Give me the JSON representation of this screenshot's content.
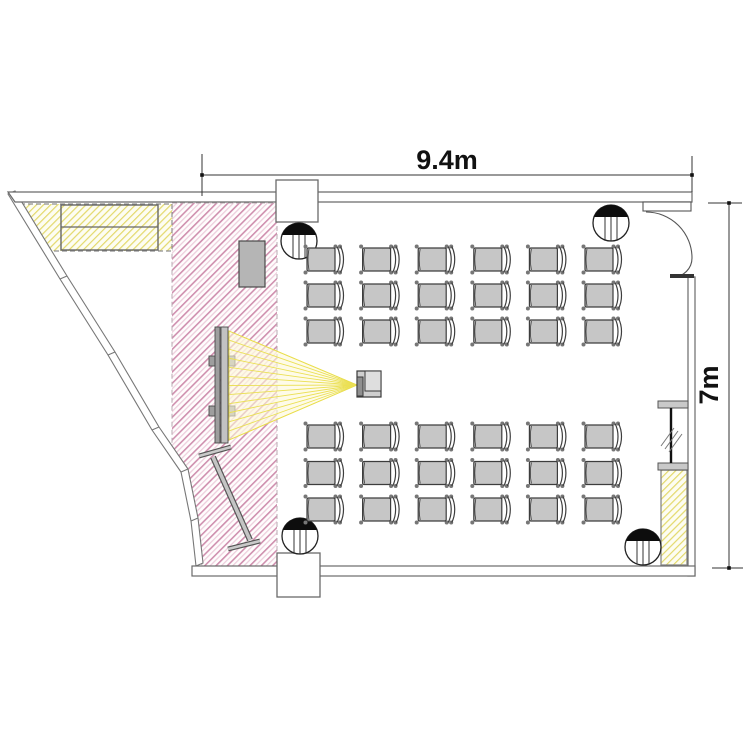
{
  "drawing": {
    "type": "floor-plan",
    "room": "classroom",
    "width_label": "9.4m",
    "height_label": "7m"
  },
  "seating": {
    "columns": 6,
    "front_rows": 3,
    "back_rows": 3,
    "total_chairs": 36
  },
  "symbols": {
    "speaker_icon_count": 4,
    "door_icon": "swing-door",
    "projector_icon": "ceiling-projector",
    "screen_icon": "projection-screen",
    "whiteboard_icon": "mobile-whiteboard",
    "lectern_icon": "lectern",
    "partition_icon": "folding-partition",
    "cabinet_icons": [
      "sideboard-top-left",
      "storage-bottom-right"
    ]
  },
  "colors": {
    "wall_line": "#6a6a6a",
    "chair_fill": "#c6c6c6",
    "chair_stroke": "#3d3d3d",
    "pink_hatch_dark": "#cf8fae",
    "pink_hatch_light": "#edcfdd",
    "yellow_hatch_line": "#e3d96b",
    "cone_line": "#eadf4e",
    "cone_fill": "#fdf8d9",
    "speaker_black": "#0d0d0d",
    "dimension_text": "#111111"
  }
}
